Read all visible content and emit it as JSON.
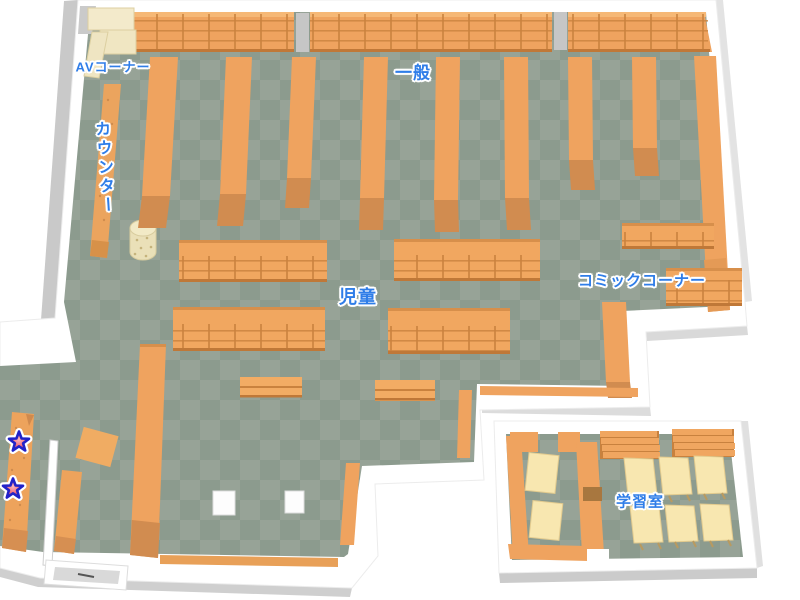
{
  "map": {
    "name": "library-floor-map",
    "labels": [
      {
        "id": "av-corner",
        "text": "AVコーナー"
      },
      {
        "id": "general",
        "text": "一般"
      },
      {
        "id": "counter",
        "text": "カウンター"
      },
      {
        "id": "children",
        "text": "児童"
      },
      {
        "id": "comic-corner",
        "text": "コミックコーナー"
      },
      {
        "id": "study-room",
        "text": "学習室"
      }
    ],
    "markers": {
      "stars": [
        {
          "x": 19,
          "y": 442
        },
        {
          "x": 13,
          "y": 489
        }
      ]
    },
    "colors": {
      "label_blue": "#2f7de8",
      "label_outline": "#ffffff",
      "floor_dark": "#8c9b8e",
      "floor_light": "#97a397",
      "wall_white": "#ffffff",
      "wall_gray": "#c9c9c9",
      "shelf_orange": "#efa35f",
      "shelf_dark_orange": "#d18c50",
      "shelf_line": "#c9823e",
      "shelf_cream": "#f3eacb",
      "table_cream": "#f8e7b0",
      "star_fill": "#e4404f",
      "star_outline": "#2222c8"
    }
  }
}
